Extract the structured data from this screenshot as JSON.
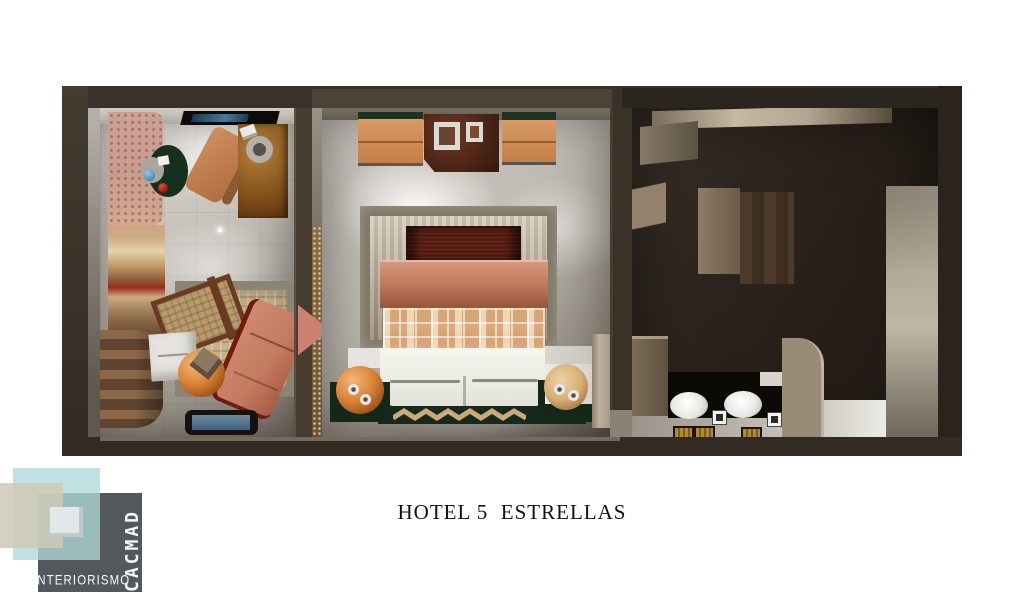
{
  "caption": {
    "title": "HOTEL 5  ESTRELLAS"
  },
  "logo": {
    "tagline": "INTERIORISMO",
    "brand": "CACMAD"
  },
  "scene": {
    "type": "3d-floorplan-render",
    "rooms": [
      "sitting-room",
      "bedroom",
      "bathroom-corridor"
    ]
  },
  "palette": {
    "wall_dark_brown": "#3a322a",
    "floor_light_gray": "#cdc9c2",
    "wood_orange": "#d28e5c",
    "copper_bed": "#c07a5c",
    "dark_green": "#17301f",
    "salmon_chair": "#c7795f",
    "duvet_white": "#ebebe5",
    "vanity_black": "#0d0a08",
    "towel_gold": "#b08a3a",
    "logo_teal": "#aed8d9",
    "logo_beige": "#cec9b5",
    "logo_gray": "#53585c"
  }
}
